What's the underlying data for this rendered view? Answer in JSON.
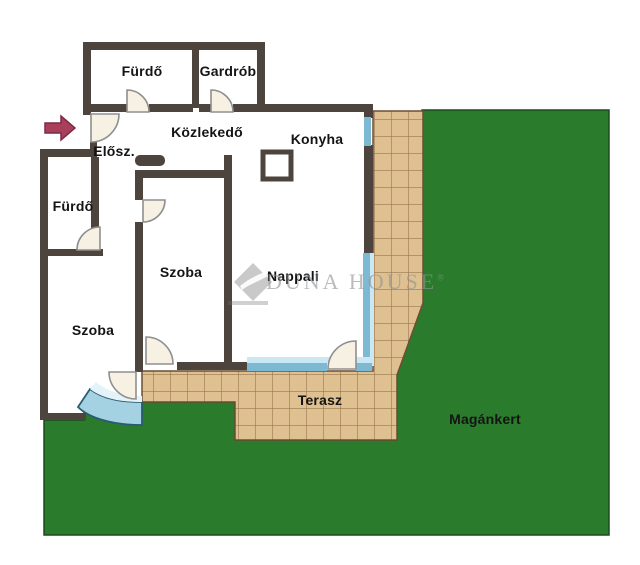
{
  "plan": {
    "rooms": {
      "furdo_top": "Fürdő",
      "gardrob": "Gardrób",
      "kozlekedo": "Közlekedő",
      "konyha": "Konyha",
      "elosz": "Elősz.",
      "furdo_left": "Fürdő",
      "szoba_mid": "Szoba",
      "nappali": "Nappali",
      "szoba_left": "Szoba",
      "terasz": "Terasz",
      "magankert": "Magánkert"
    },
    "watermark": {
      "brand": "DUNA HOUSE",
      "registered": "®"
    },
    "colors": {
      "wall": "#4d443e",
      "garden_green": "#2b7b2d",
      "terrace_tile": "#dfc091",
      "tile_grid": "#9a7851",
      "glass_blue": "#7db9d2",
      "glass_light": "#c9e8f4",
      "door_fill": "#f7f1e4",
      "entrance_arrow": "#a8405c",
      "watermark_gray": "#8f9396"
    }
  }
}
